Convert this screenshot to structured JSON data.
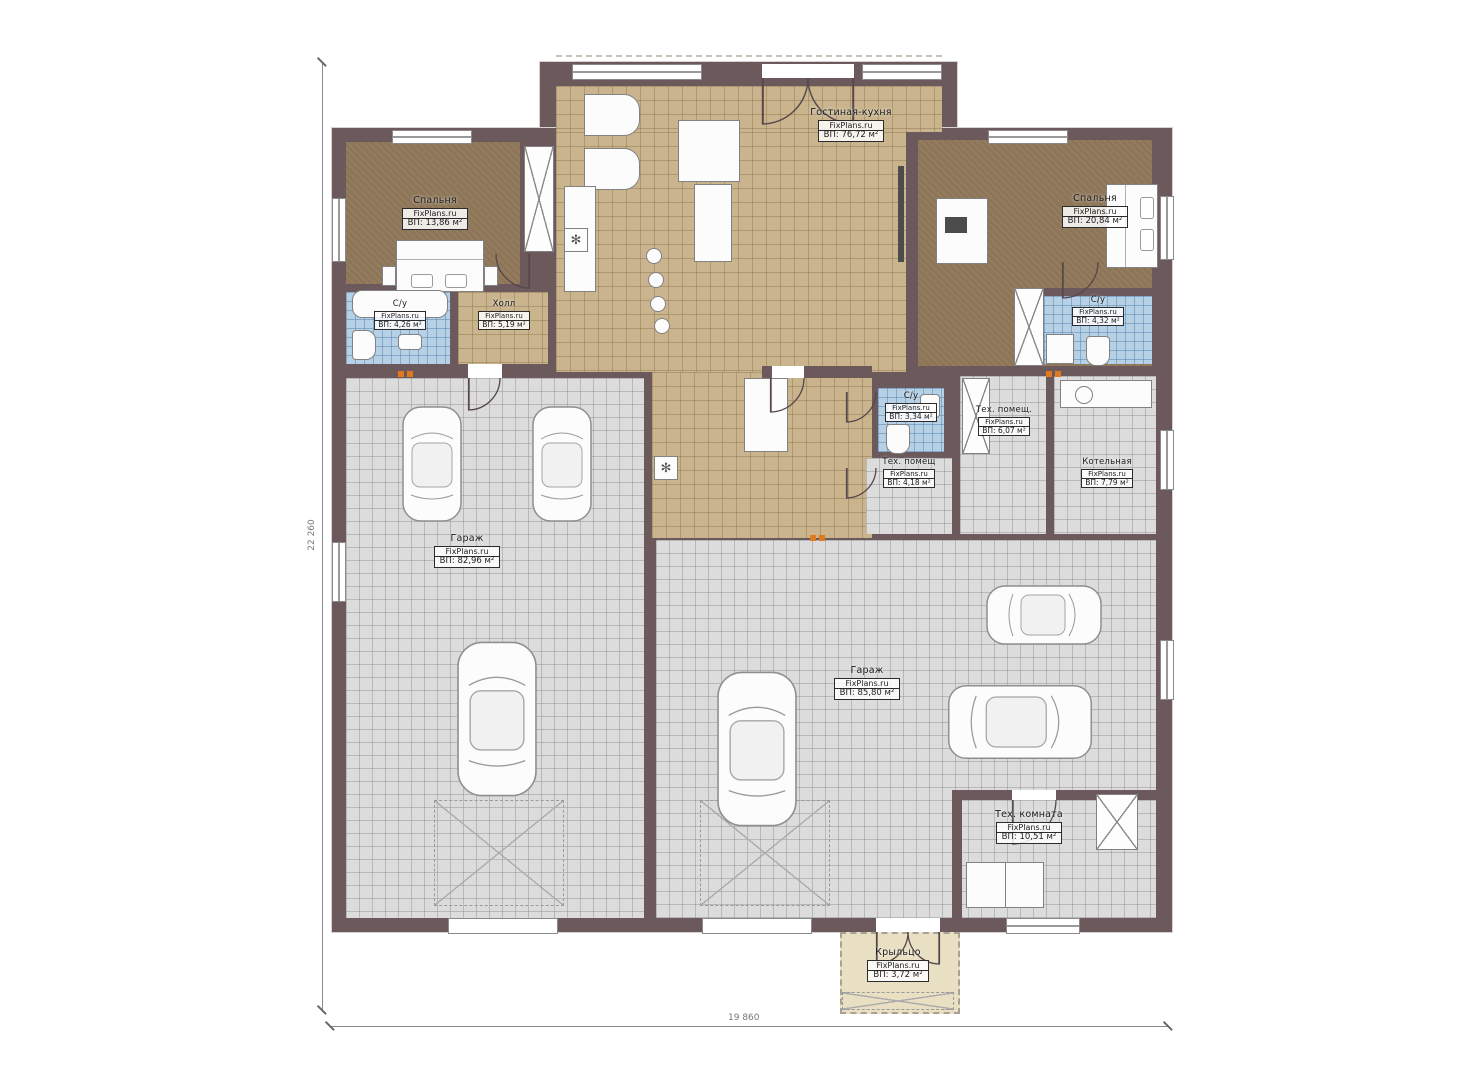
{
  "brand": "FixPlans.ru",
  "dimensions": {
    "vertical": "22 260",
    "horizontal": "19 860"
  },
  "rooms": {
    "living": {
      "name": "Гостиная-кухня",
      "area": "ВП: 76,72 м²"
    },
    "bedroom_left": {
      "name": "Спальня",
      "area": "ВП: 13,86 м²"
    },
    "bedroom_right": {
      "name": "Спальня",
      "area": "ВП: 20,84 м²"
    },
    "hall": {
      "name": "Холл",
      "area": "ВП: 5,19 м²"
    },
    "bath_left": {
      "name": "С/у",
      "area": "ВП: 4,26 м²"
    },
    "bath_right": {
      "name": "С/у",
      "area": "ВП: 4,32 м²"
    },
    "bath_mid": {
      "name": "С/у",
      "area": "ВП: 3,34 м²"
    },
    "tech_top": {
      "name": "Тех. помещ.",
      "area": "ВП: 6,07 м²"
    },
    "tech_mid": {
      "name": "Тех. помещ",
      "area": "ВП: 4,18 м²"
    },
    "boiler": {
      "name": "Котельная",
      "area": "ВП: 7,79 м²"
    },
    "garage_left": {
      "name": "Гараж",
      "area": "ВП: 82,96 м²"
    },
    "garage_right": {
      "name": "Гараж",
      "area": "ВП: 85,80 м²"
    },
    "tech_room": {
      "name": "Тех. комната",
      "area": "ВП: 10,51 м²"
    },
    "porch": {
      "name": "Крыльцо",
      "area": "ВП: 3,72 м²"
    }
  },
  "colors": {
    "wall": "#6b595c",
    "tile_tan": "#c9b48e",
    "carpet": "#8d7557",
    "tile_blue": "#b6d0e6",
    "tile_gray": "#dcdcdc",
    "porch": "#e9dfc2",
    "vent_orange": "#e07a1e"
  }
}
